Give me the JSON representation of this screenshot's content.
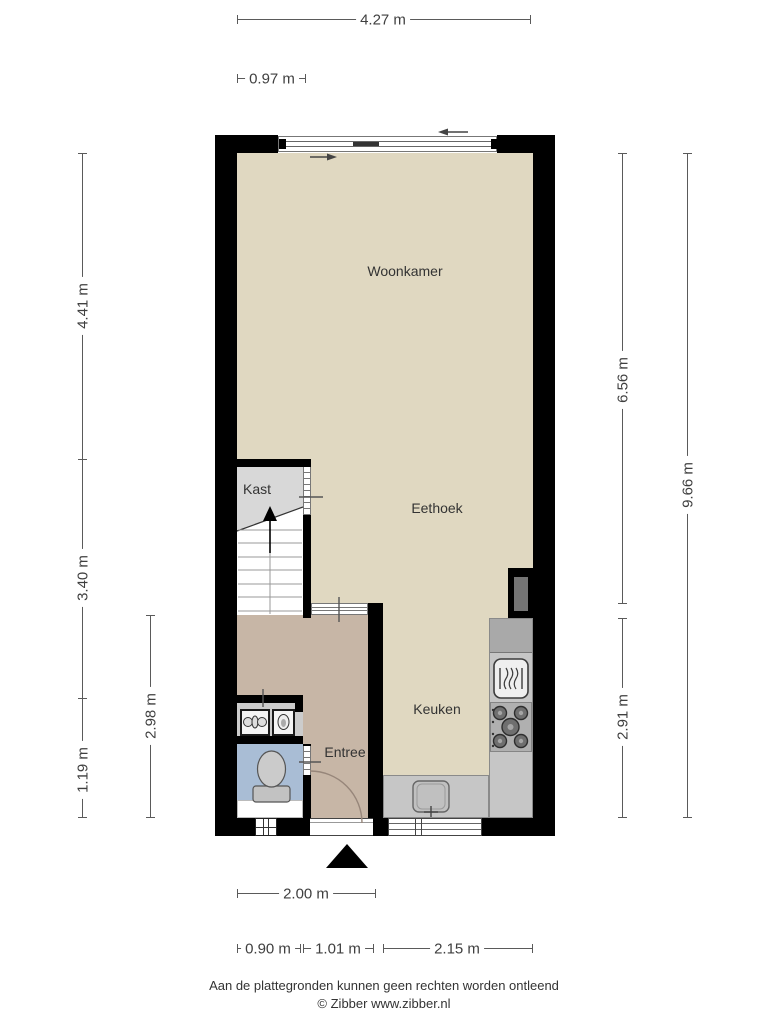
{
  "rooms": {
    "woonkamer": {
      "label": "Woonkamer"
    },
    "eethoek": {
      "label": "Eethoek"
    },
    "kast": {
      "label": "Kast"
    },
    "keuken": {
      "label": "Keuken"
    },
    "entree": {
      "label": "Entree"
    }
  },
  "dimensions": {
    "total_width": "4.27 m",
    "kast_width": "0.97 m",
    "woonkamer_depth": "4.41 m",
    "middle_depth": "3.40 m",
    "toilet_depth": "1.19 m",
    "entree_depth": "2.98 m",
    "right_upper_depth": "6.56 m",
    "total_depth": "9.66 m",
    "keuken_depth": "2.91 m",
    "entree_width": "2.00 m",
    "bottom_left_width": "0.90 m",
    "bottom_door_width": "1.01 m",
    "bottom_right_width": "2.15 m"
  },
  "footer": {
    "disclaimer": "Aan de plattegronden kunnen geen rechten worden ontleend",
    "copyright": "© Zibber www.zibber.nl"
  },
  "colors": {
    "wall": "#000000",
    "floor_main": "#e0d8c1",
    "floor_entree": "#c7b6a6",
    "floor_toilet": "#a9bdd5",
    "floor_kast": "#d8d8d8",
    "counter": "#c6c6c6",
    "dimension_text": "#3f3f3f"
  }
}
